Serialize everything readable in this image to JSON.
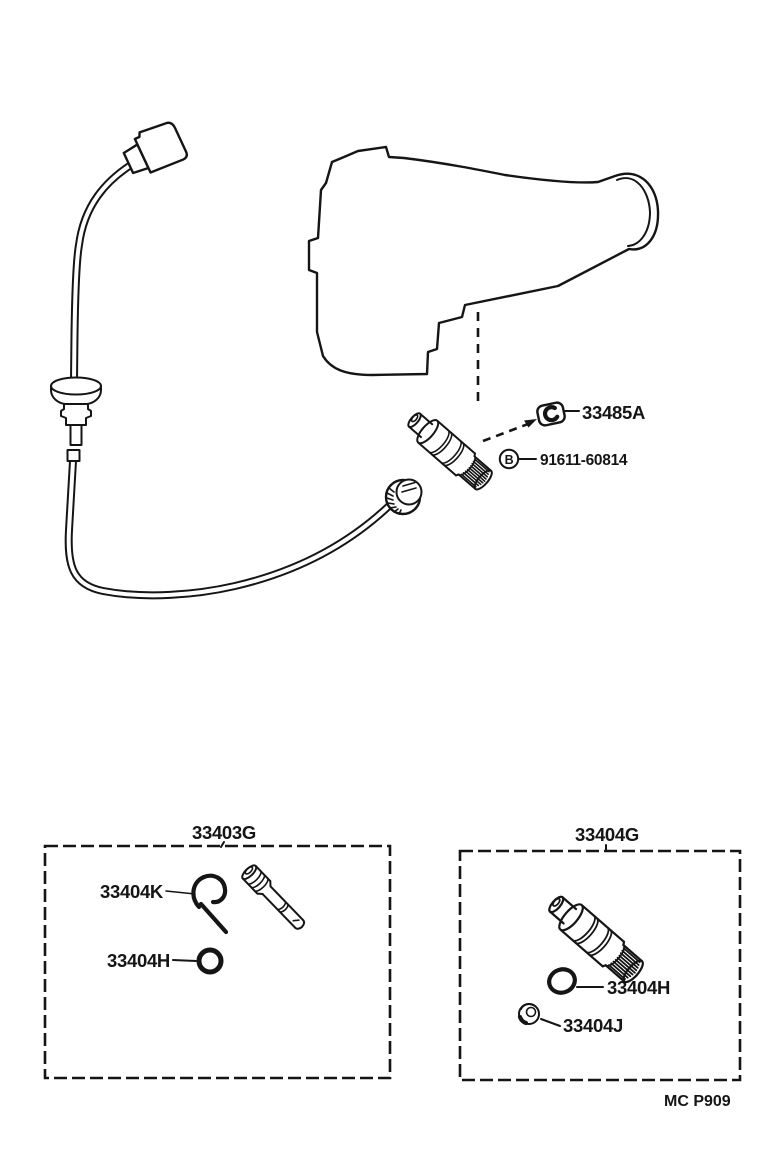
{
  "document": {
    "kind": "speedometer-driven-gear-parts-diagram",
    "footer_code": "MC P909",
    "ink": "#151515",
    "paper": "#ffffff"
  },
  "main": {
    "callouts": [
      {
        "label": "33485A",
        "marker": ""
      },
      {
        "label": "91611-60814",
        "marker": "B"
      }
    ]
  },
  "kits": [
    {
      "title": "33403G",
      "parts": [
        {
          "label": "33404K"
        },
        {
          "label": "33404H"
        }
      ]
    },
    {
      "title": "33404G",
      "parts": [
        {
          "label": "33404H"
        },
        {
          "label": "33404J"
        }
      ]
    }
  ]
}
